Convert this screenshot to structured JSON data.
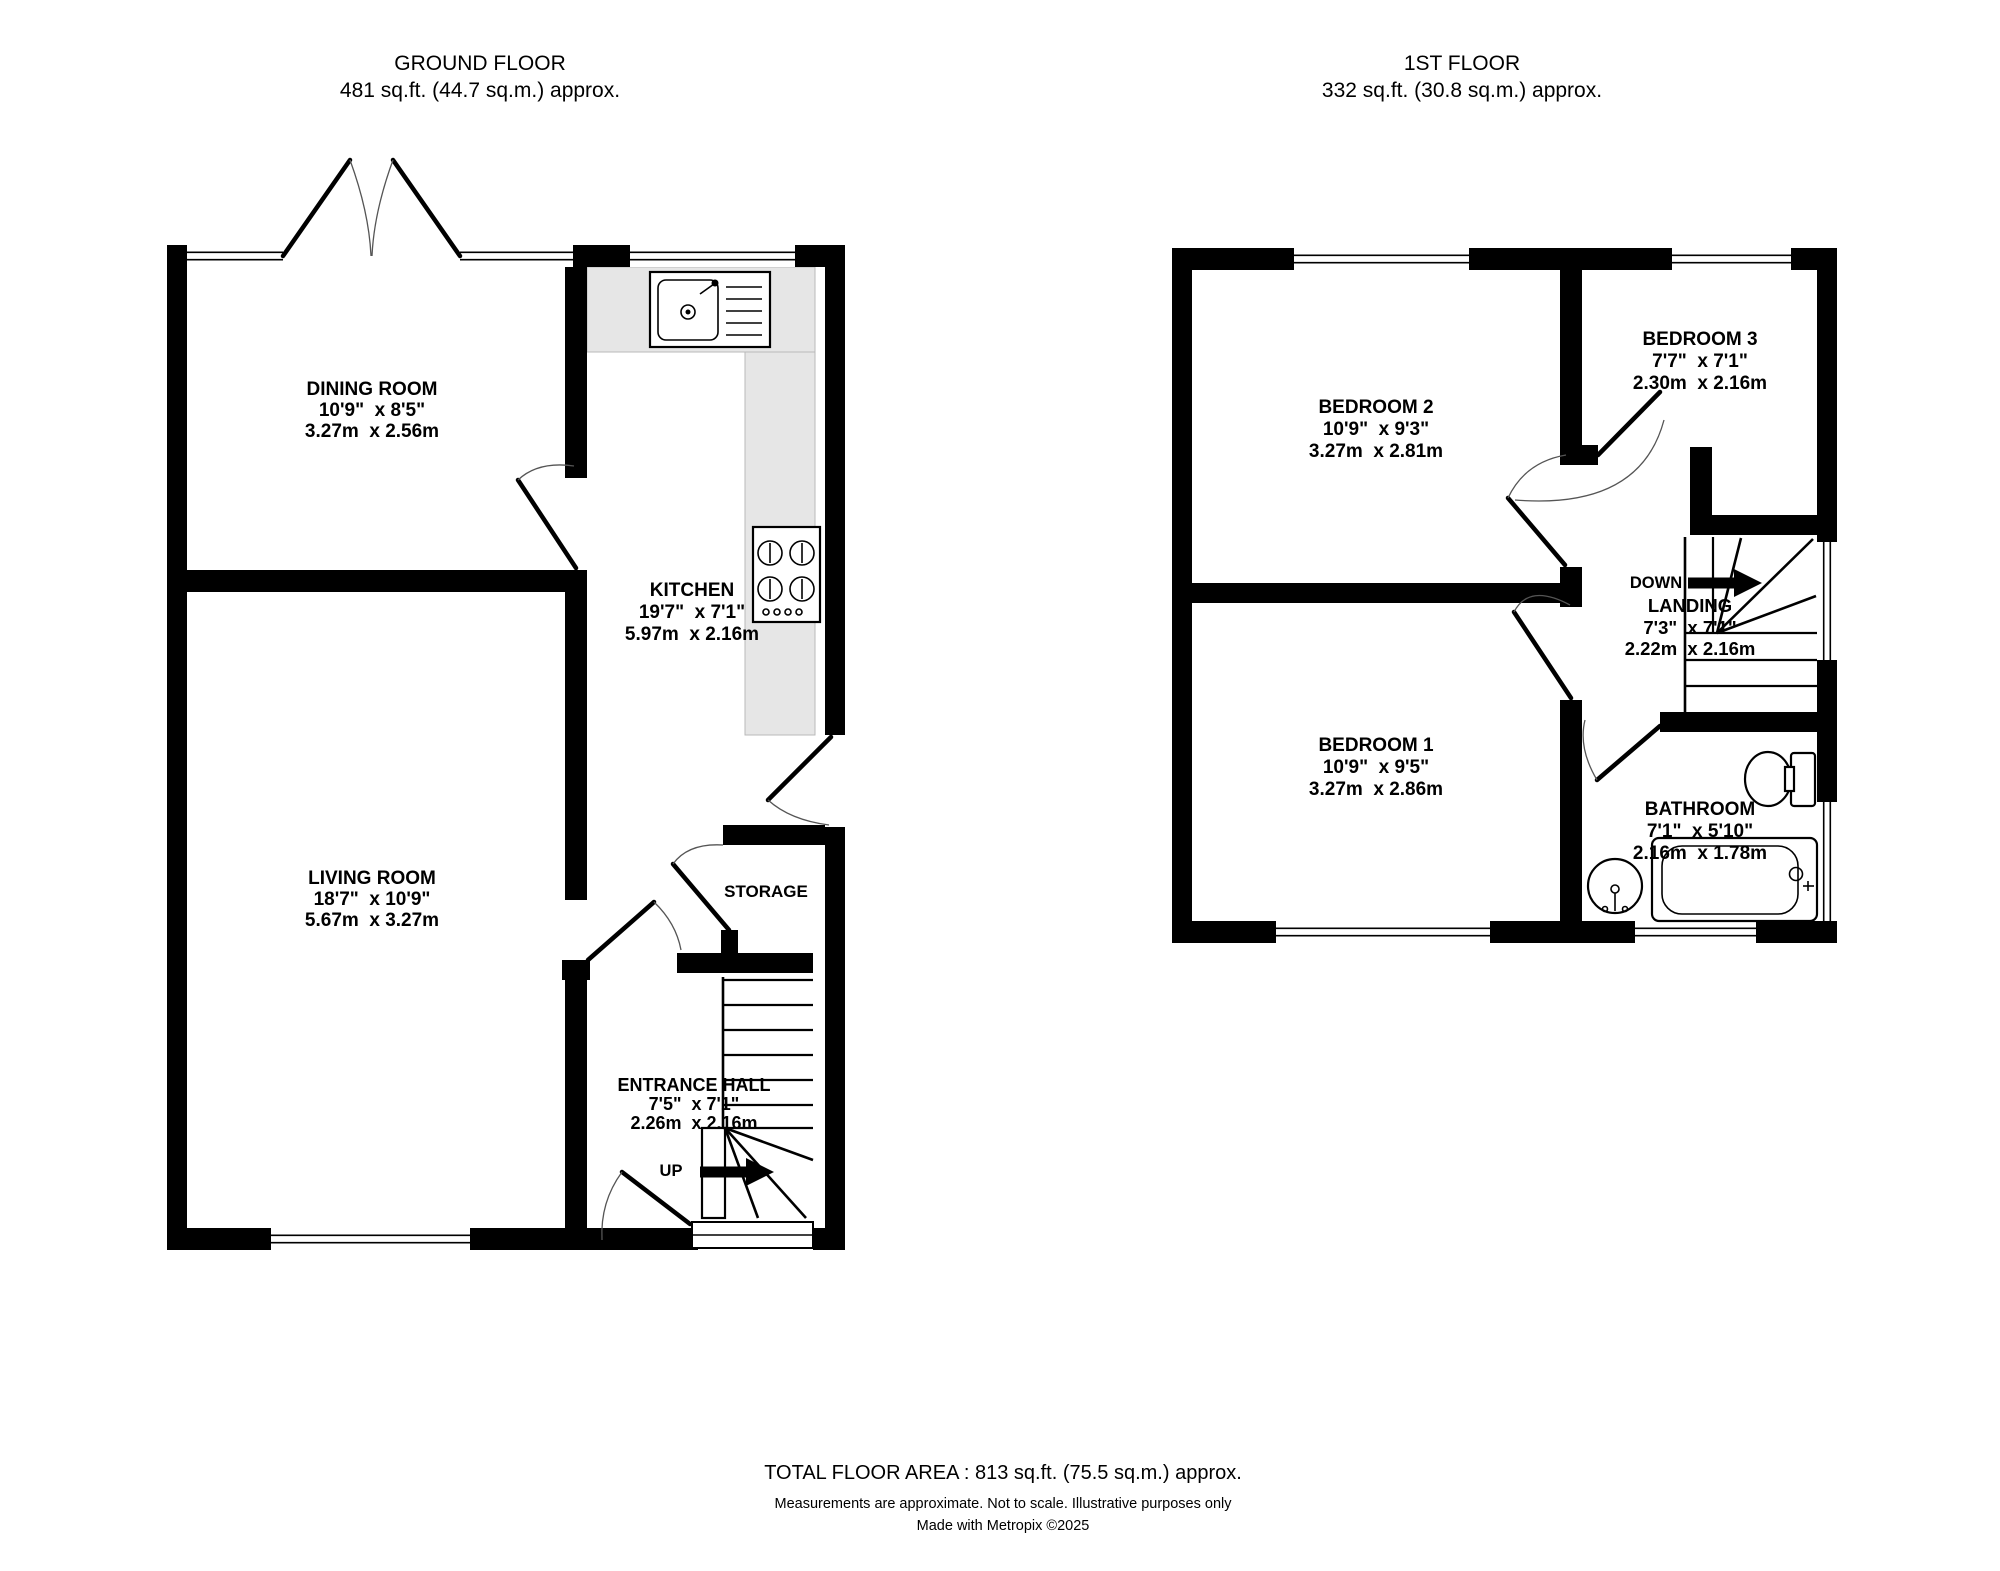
{
  "ground_floor": {
    "title": "GROUND FLOOR",
    "area": "481 sq.ft. (44.7 sq.m.) approx.",
    "rooms": {
      "dining": {
        "name": "DINING ROOM",
        "imperial": "10'9\"  x 8'5\"",
        "metric": "3.27m  x 2.56m"
      },
      "kitchen": {
        "name": "KITCHEN",
        "imperial": "19'7\"  x 7'1\"",
        "metric": "5.97m  x 2.16m"
      },
      "living": {
        "name": "LIVING ROOM",
        "imperial": "18'7\"  x 10'9\"",
        "metric": "5.67m  x 3.27m"
      },
      "entrance": {
        "name": "ENTRANCE HALL",
        "imperial": "7'5\"  x 7'1\"",
        "metric": "2.26m  x 2.16m"
      },
      "storage": {
        "name": "STORAGE"
      }
    },
    "stairs_label": "UP"
  },
  "first_floor": {
    "title": "1ST FLOOR",
    "area": "332 sq.ft. (30.8 sq.m.) approx.",
    "rooms": {
      "bedroom2": {
        "name": "BEDROOM 2",
        "imperial": "10'9\"  x 9'3\"",
        "metric": "3.27m  x 2.81m"
      },
      "bedroom3": {
        "name": "BEDROOM 3",
        "imperial": "7'7\"  x 7'1\"",
        "metric": "2.30m  x 2.16m"
      },
      "bedroom1": {
        "name": "BEDROOM 1",
        "imperial": "10'9\"  x 9'5\"",
        "metric": "3.27m  x 2.86m"
      },
      "landing": {
        "name": "LANDING",
        "imperial": "7'3\"  x 7'1\"",
        "metric": "2.22m  x 2.16m"
      },
      "bathroom": {
        "name": "BATHROOM",
        "imperial": "7'1\"  x 5'10\"",
        "metric": "2.16m  x 1.78m"
      }
    },
    "stairs_label": "DOWN"
  },
  "footer": {
    "total_area": "TOTAL FLOOR AREA : 813 sq.ft. (75.5 sq.m.) approx.",
    "disclaimer": "Measurements are approximate.  Not to scale.  Illustrative purposes only",
    "credit": "Made with Metropix ©2025"
  },
  "colors": {
    "wall": "#000000",
    "counter": "#e6e6e6",
    "background": "#ffffff"
  }
}
